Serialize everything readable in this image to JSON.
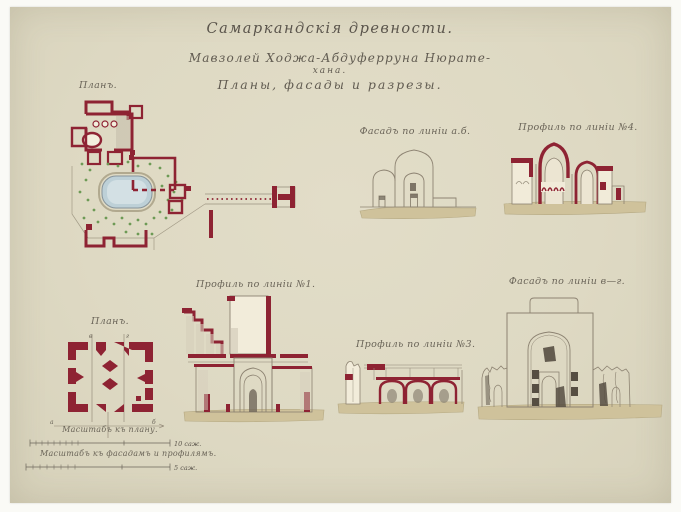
{
  "artwork": {
    "title_line1": "Самаркандскія древности.",
    "title_line2": "Мавзолей Ходжа-Абдуферруна Нюрате-",
    "title_line3": "хана.",
    "title_line4": "Планы, фасады и разрезы."
  },
  "figures": {
    "site_plan": {
      "caption": "Планъ."
    },
    "facade_ab": {
      "caption": "Фасадъ по линіи а.б."
    },
    "profile_4": {
      "caption": "Профиль по линіи №4."
    },
    "small_plan": {
      "caption": "Планъ.",
      "mark_line1": "в",
      "mark_line2": "г",
      "mark_left": "а",
      "mark_right": "б"
    },
    "profile_1": {
      "caption": "Профиль по линіи №1."
    },
    "profile_3": {
      "caption": "Профиль по линіи №3."
    },
    "facade_vg": {
      "caption": "Фасадъ по линіи в—г."
    }
  },
  "scales": {
    "plan": {
      "caption": "Масштабъ къ плану.",
      "unit_label": "10 саж."
    },
    "elevations": {
      "caption": "Масштабъ къ фасадамъ и профилямъ.",
      "unit_label": "5 саж."
    }
  },
  "colors": {
    "paper": "#ded9c3",
    "ink_red": "#8e2333",
    "ground_tan": "#cfc29b",
    "pond_blue": "#bdd0d7",
    "tree_green": "#6d9a55",
    "line_sepia": "#8d8372",
    "text_ink": "#5b554c"
  }
}
